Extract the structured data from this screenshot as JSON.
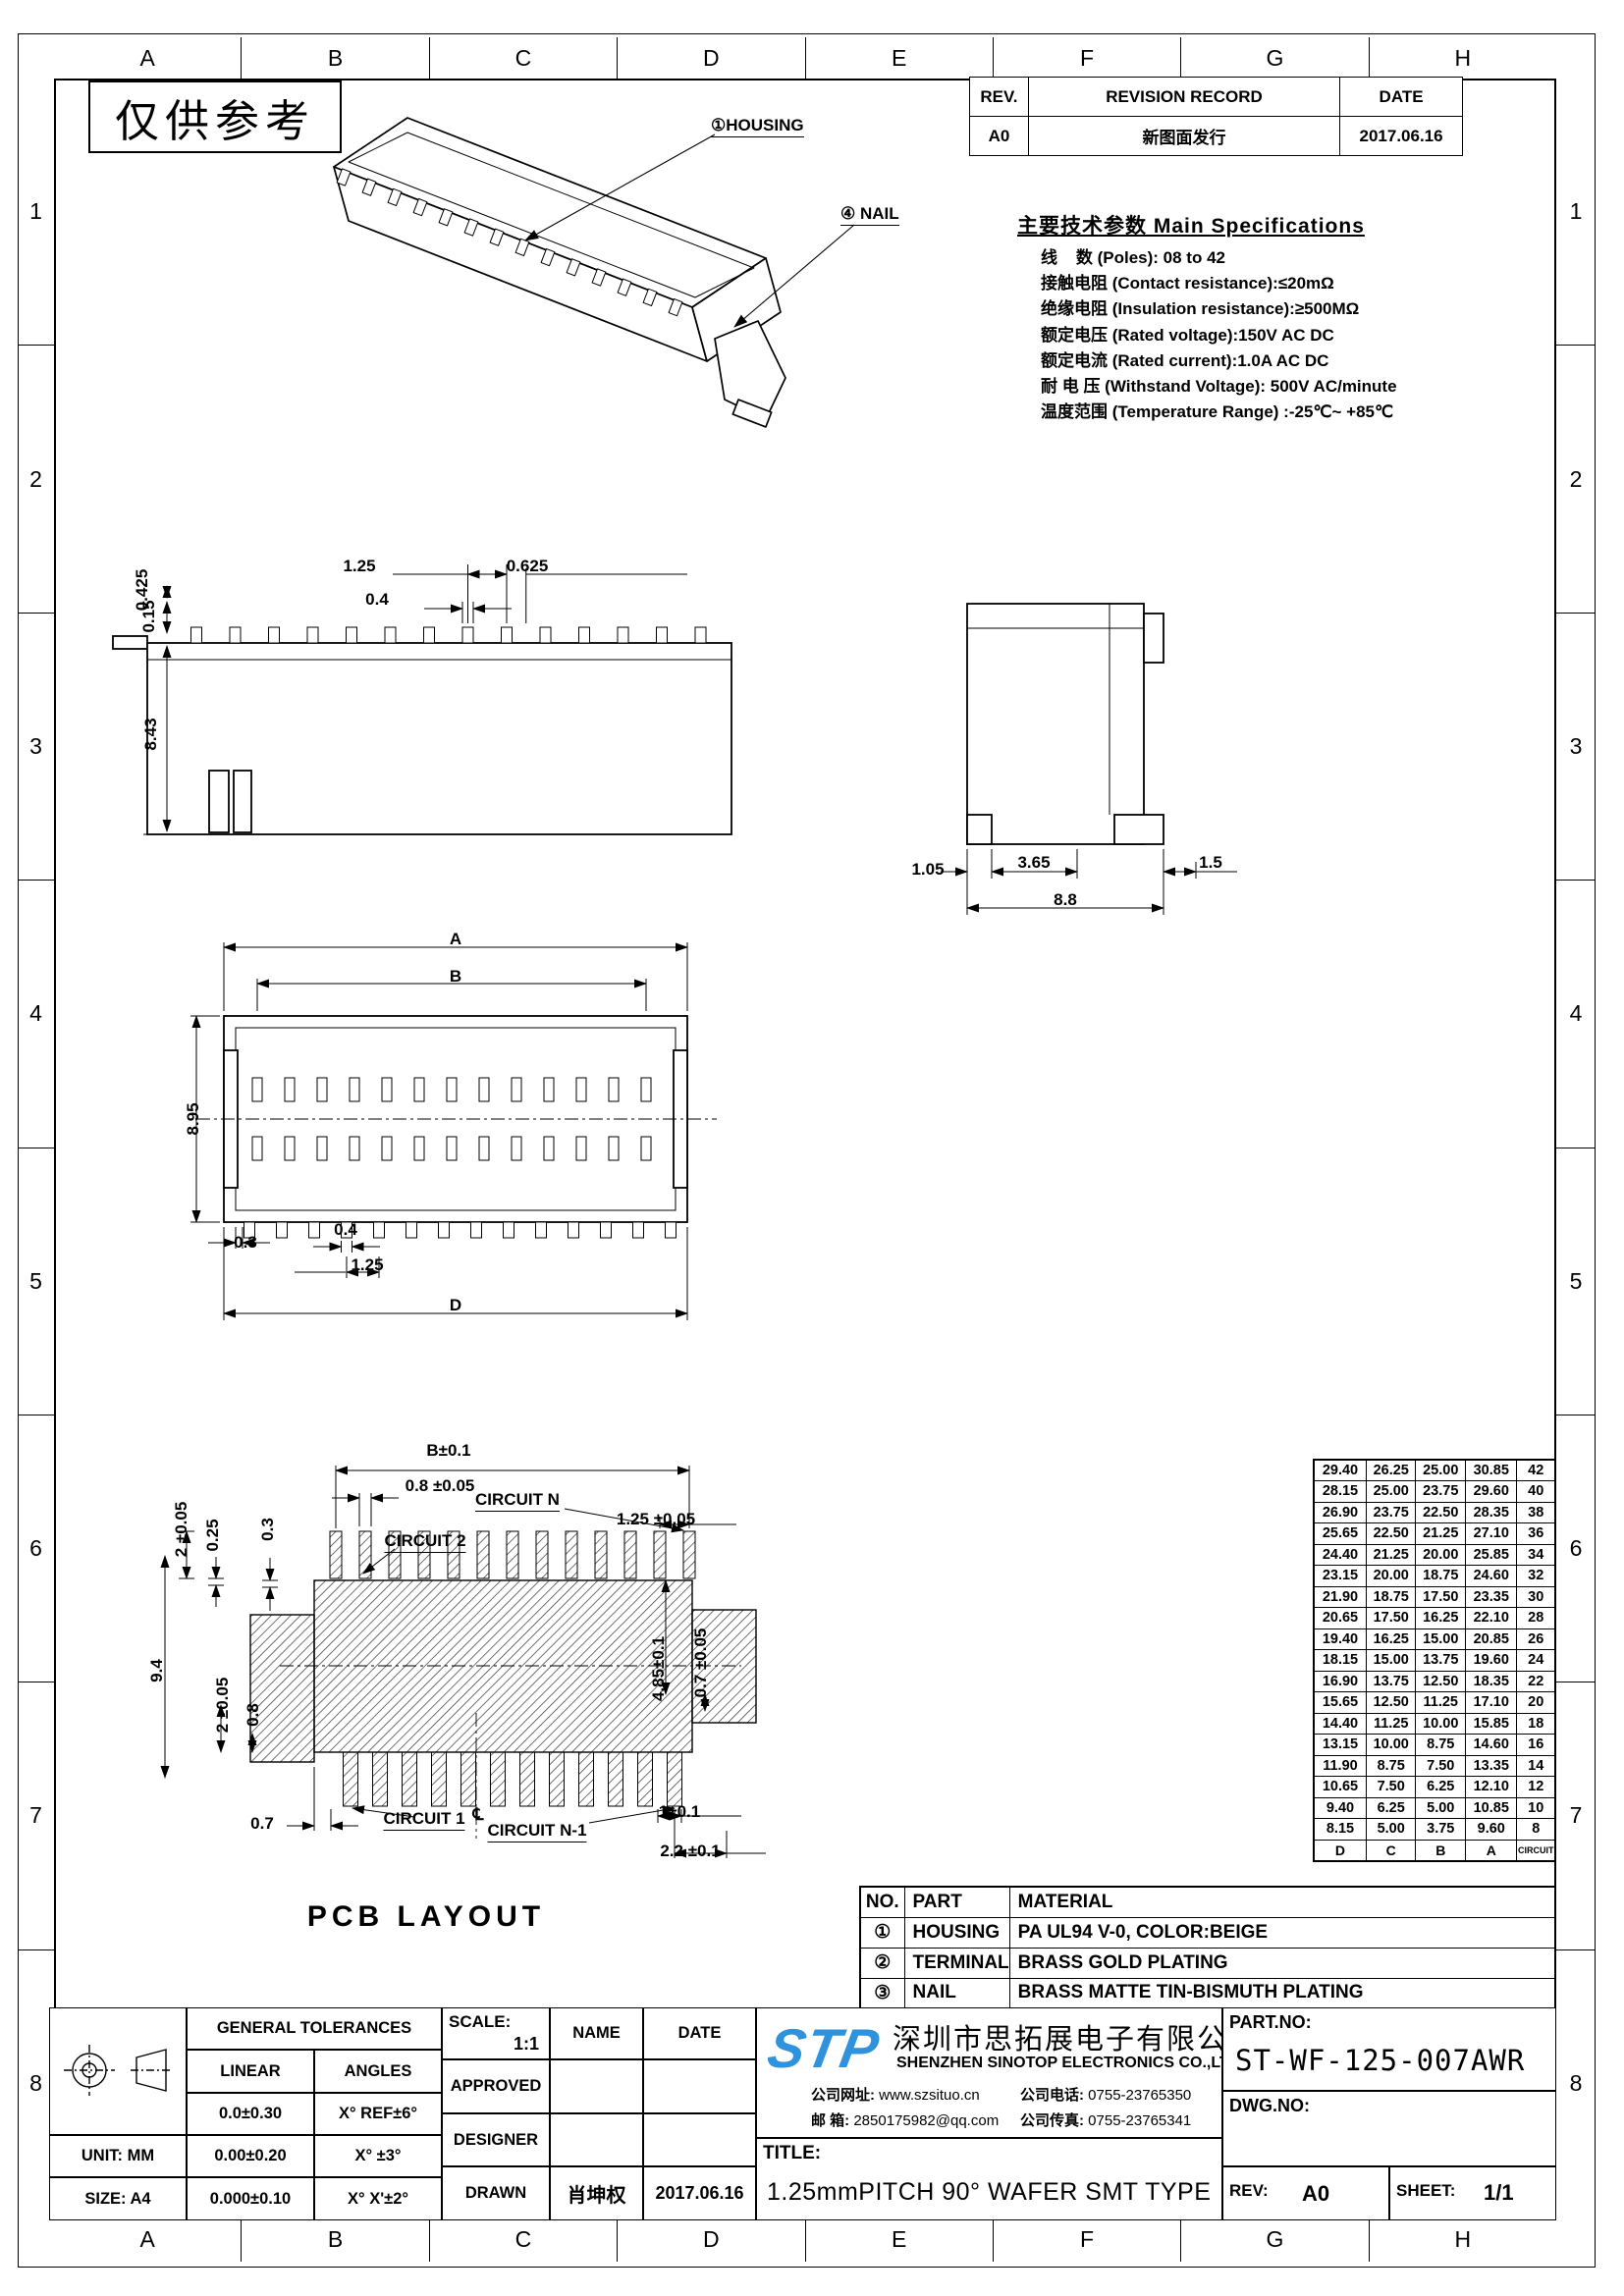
{
  "sheet": {
    "watermark": "仅供参考",
    "grid_letters": [
      "A",
      "B",
      "C",
      "D",
      "E",
      "F",
      "G",
      "H"
    ],
    "grid_numbers": [
      "1",
      "2",
      "3",
      "4",
      "5",
      "6",
      "7",
      "8"
    ]
  },
  "revision_table": {
    "rev_header": "REV.",
    "record_header": "REVISION RECORD",
    "date_header": "DATE",
    "rows": [
      {
        "rev": "A0",
        "record": "新图面发行",
        "date": "2017.06.16"
      }
    ]
  },
  "specifications": {
    "title": "主要技术参数 Main Specifications",
    "lines": [
      "线    数 (Poles): 08 to 42",
      "接触电阻 (Contact resistance):≤20mΩ",
      "绝缘电阻 (Insulation resistance):≥500MΩ",
      "额定电压 (Rated voltage):150V AC DC",
      "额定电流 (Rated current):1.0A AC DC",
      "耐 电 压 (Withstand Voltage): 500V AC/minute",
      "温度范围 (Temperature Range) :-25℃~ +85℃"
    ]
  },
  "iso_view": {
    "housing_callout": "①HOUSING",
    "nail_callout": "④ NAIL"
  },
  "front_view": {
    "dim_pitch": "1.25",
    "dim_half_pitch": "0.625",
    "dim_pad": "0.4",
    "dim_height": "8.43",
    "dim_tail": "0.425",
    "dim_thickness": "0.15"
  },
  "side_view": {
    "dim_left": "1.05",
    "dim_mid": "3.65",
    "dim_right": "1.5",
    "dim_total": "8.8"
  },
  "top_view": {
    "dim_a": "A",
    "dim_b": "B",
    "dim_height": "8.95",
    "dim_03": "0.3",
    "dim_04": "0.4",
    "dim_pitch": "1.25",
    "dim_d": "D"
  },
  "pcb_layout": {
    "caption": "PCB LAYOUT",
    "dim_b": "B±0.1",
    "dim_pad_w": "0.8 ±0.05",
    "circuit_n": "CIRCUIT N",
    "dim_pitch": "1.25 ±0.05",
    "circuit_2": "CIRCUIT 2",
    "dim_2a": "2 ±0.05",
    "dim_025": "0.25",
    "dim_03": "0.3",
    "dim_94": "9.4",
    "dim_2b": "2 ±0.05",
    "dim_08": "0.8",
    "dim_485": "4.85±0.1",
    "dim_07t": "0.7 ±0.05",
    "dim_07": "0.7",
    "circuit_1": "CIRCUIT 1",
    "centerline": "℄",
    "circuit_n1": "CIRCUIT N-1",
    "dim_1": "1±0.1",
    "dim_22": "2.2 ±0.1"
  },
  "dimension_table": {
    "headers": [
      "D",
      "C",
      "B",
      "A",
      "CIRCUIT"
    ],
    "rows": [
      [
        "29.40",
        "26.25",
        "25.00",
        "30.85",
        "42"
      ],
      [
        "28.15",
        "25.00",
        "23.75",
        "29.60",
        "40"
      ],
      [
        "26.90",
        "23.75",
        "22.50",
        "28.35",
        "38"
      ],
      [
        "25.65",
        "22.50",
        "21.25",
        "27.10",
        "36"
      ],
      [
        "24.40",
        "21.25",
        "20.00",
        "25.85",
        "34"
      ],
      [
        "23.15",
        "20.00",
        "18.75",
        "24.60",
        "32"
      ],
      [
        "21.90",
        "18.75",
        "17.50",
        "23.35",
        "30"
      ],
      [
        "20.65",
        "17.50",
        "16.25",
        "22.10",
        "28"
      ],
      [
        "19.40",
        "16.25",
        "15.00",
        "20.85",
        "26"
      ],
      [
        "18.15",
        "15.00",
        "13.75",
        "19.60",
        "24"
      ],
      [
        "16.90",
        "13.75",
        "12.50",
        "18.35",
        "22"
      ],
      [
        "15.65",
        "12.50",
        "11.25",
        "17.10",
        "20"
      ],
      [
        "14.40",
        "11.25",
        "10.00",
        "15.85",
        "18"
      ],
      [
        "13.15",
        "10.00",
        "8.75",
        "14.60",
        "16"
      ],
      [
        "11.90",
        "8.75",
        "7.50",
        "13.35",
        "14"
      ],
      [
        "10.65",
        "7.50",
        "6.25",
        "12.10",
        "12"
      ],
      [
        "9.40",
        "6.25",
        "5.00",
        "10.85",
        "10"
      ],
      [
        "8.15",
        "5.00",
        "3.75",
        "9.60",
        "8"
      ]
    ]
  },
  "material_table": {
    "no_header": "NO.",
    "part_header": "PART",
    "material_header": "MATERIAL",
    "rows": [
      {
        "no": "①",
        "part": "HOUSING",
        "material": "PA UL94 V-0, COLOR:BEIGE"
      },
      {
        "no": "②",
        "part": "TERMINAL",
        "material": "BRASS GOLD PLATING"
      },
      {
        "no": "③",
        "part": "NAIL",
        "material": "BRASS MATTE TIN-BISMUTH PLATING"
      }
    ]
  },
  "tolerance_block": {
    "title": "GENERAL TOLERANCES",
    "linear_header": "LINEAR",
    "angles_header": "ANGLES",
    "rows": [
      {
        "linear": "0.0±0.30",
        "angles": "X° REF±6°"
      },
      {
        "linear": "0.00±0.20",
        "angles": "X° ±3°"
      },
      {
        "linear": "0.000±0.10",
        "angles": "X° X'±2°"
      }
    ],
    "unit_label": "UNIT: MM",
    "size_label": "SIZE: A4"
  },
  "title_block": {
    "scale_label": "SCALE:",
    "scale_value": "1:1",
    "name_header": "NAME",
    "date_header": "DATE",
    "approved_label": "APPROVED",
    "designer_label": "DESIGNER",
    "drawn_label": "DRAWN",
    "drawn_name": "肖坤权",
    "drawn_date": "2017.06.16",
    "logo": "STP",
    "company_cn": "深圳市思拓展电子有限公司",
    "company_en": "SHENZHEN SINOTOP ELECTRONICS CO.,LTD",
    "website_label": "公司网址:",
    "website": "www.szsituo.cn",
    "phone_label": "公司电话:",
    "phone": "0755-23765350",
    "email_label": "邮  箱:",
    "email": "2850175982@qq.com",
    "fax_label": "公司传真:",
    "fax": "0755-23765341",
    "title_label": "TITLE:",
    "title_value": "1.25mmPITCH 90° WAFER SMT TYPE",
    "part_no_label": "PART.NO:",
    "part_no": "ST-WF-125-007AWR",
    "dwg_no_label": "DWG.NO:",
    "rev_label": "REV:",
    "rev_value": "A0",
    "sheet_label": "SHEET:",
    "sheet_value": "1/1"
  }
}
